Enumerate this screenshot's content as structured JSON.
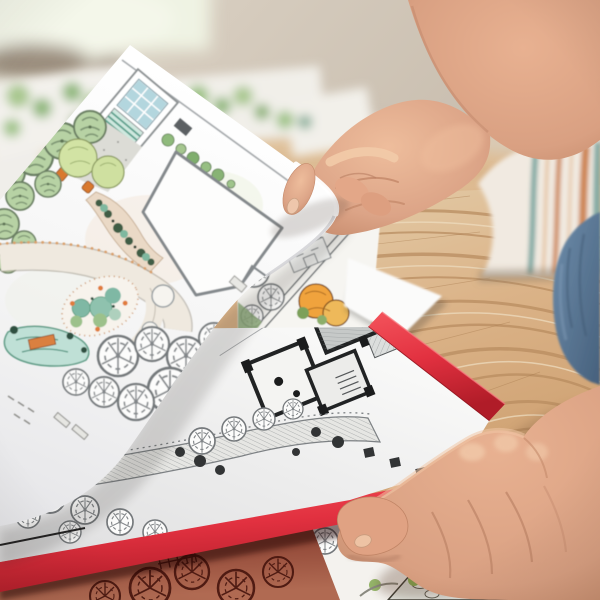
{
  "meta": {
    "type": "photograph",
    "alt": "Hands of a designer reviewing hand-drawn landscape garden plans and a black-and-white site plan in a red portfolio on a wooden table"
  },
  "palette": {
    "wall": "#cec4b6",
    "wall-light": "#eff3e3",
    "wood": "#dbb388",
    "wood-dark": "#b98d60",
    "wood-light": "#ecd9bb",
    "paper": "#f7f6f4",
    "paper-dim": "#e8e8ea",
    "red-cover": "#e23140",
    "red-cover-dark": "#a51824",
    "skin": "#d9a082",
    "skin-light": "#efc7a7",
    "skin-shadow": "#bd8264",
    "denim": "#587a9b",
    "denim-dark": "#46607c",
    "apron": "#f1eae1",
    "apron-rust": "#cd8552",
    "apron-teal": "#7fa9a3",
    "green-sage": "#b7d2a4",
    "green-line": "#6b7f63",
    "green-yellow": "#d2e3a4",
    "teal-plant": "#7fb8a4",
    "glass-blue": "#b3d6de",
    "orange-accent": "#dd8040",
    "ink": "#3f4345",
    "ink-light": "#8d9296",
    "maroon": "#a05a48",
    "maroon-dark": "#53150f",
    "maroon-line": "#46140d",
    "plan-green": "#a9c161",
    "plan-green-dark": "#4d6326",
    "deck-brown": "#b57c46",
    "deck-dark": "#7e5327",
    "outline-dark": "#2e2d26",
    "stone-grey": "#e3e6e0"
  },
  "scene": {
    "background": {
      "wall": "blurred beige wall",
      "window_light": "soft daylight from upper left"
    },
    "table": {
      "material": "pine wood",
      "grain": "wavy cathedral grain, sharp focus centre-right"
    },
    "papers": [
      {
        "name": "scattered-plan-sheets",
        "desc": "out-of-focus sheets with green planting sketches",
        "position": "upper left on table"
      },
      {
        "name": "garden-plan-top-sheet",
        "desc": "hand-rendered landscape plan: greenhouse with blue glazing, sage tree symbols, house footprint, ponds, curved paths, uncoloured scalloped trees",
        "state": "lifted by right hand"
      },
      {
        "name": "sketch-sheet",
        "desc": "planting sketch sheet with green trees, facade elevation and orange tree rendering",
        "position": "centre, under top sheet"
      },
      {
        "name": "blank-sheet-corner",
        "desc": "bright white sheet corner",
        "position": "centre right"
      },
      {
        "name": "red-portfolio",
        "desc": "red-covered portfolio holding a black-and-white site plan page",
        "position": "lower left"
      },
      {
        "name": "colorful-plan-bottom-sheet",
        "desc": "marker-rendered garden plan with wooden deck, stone path, lawn and trees",
        "position": "bottom right"
      },
      {
        "name": "shadowed-sheet",
        "desc": "tree-symbol line drawing tinted red by shadow of the portfolio",
        "position": "bottom left"
      }
    ],
    "person": {
      "right_hand": "lifting the corner of the garden plan sheet",
      "left_hand": "resting on the portfolio edge, thumb under the red cover",
      "clothing": [
        "white apron with rust and teal stripes",
        "blue jeans"
      ]
    }
  }
}
